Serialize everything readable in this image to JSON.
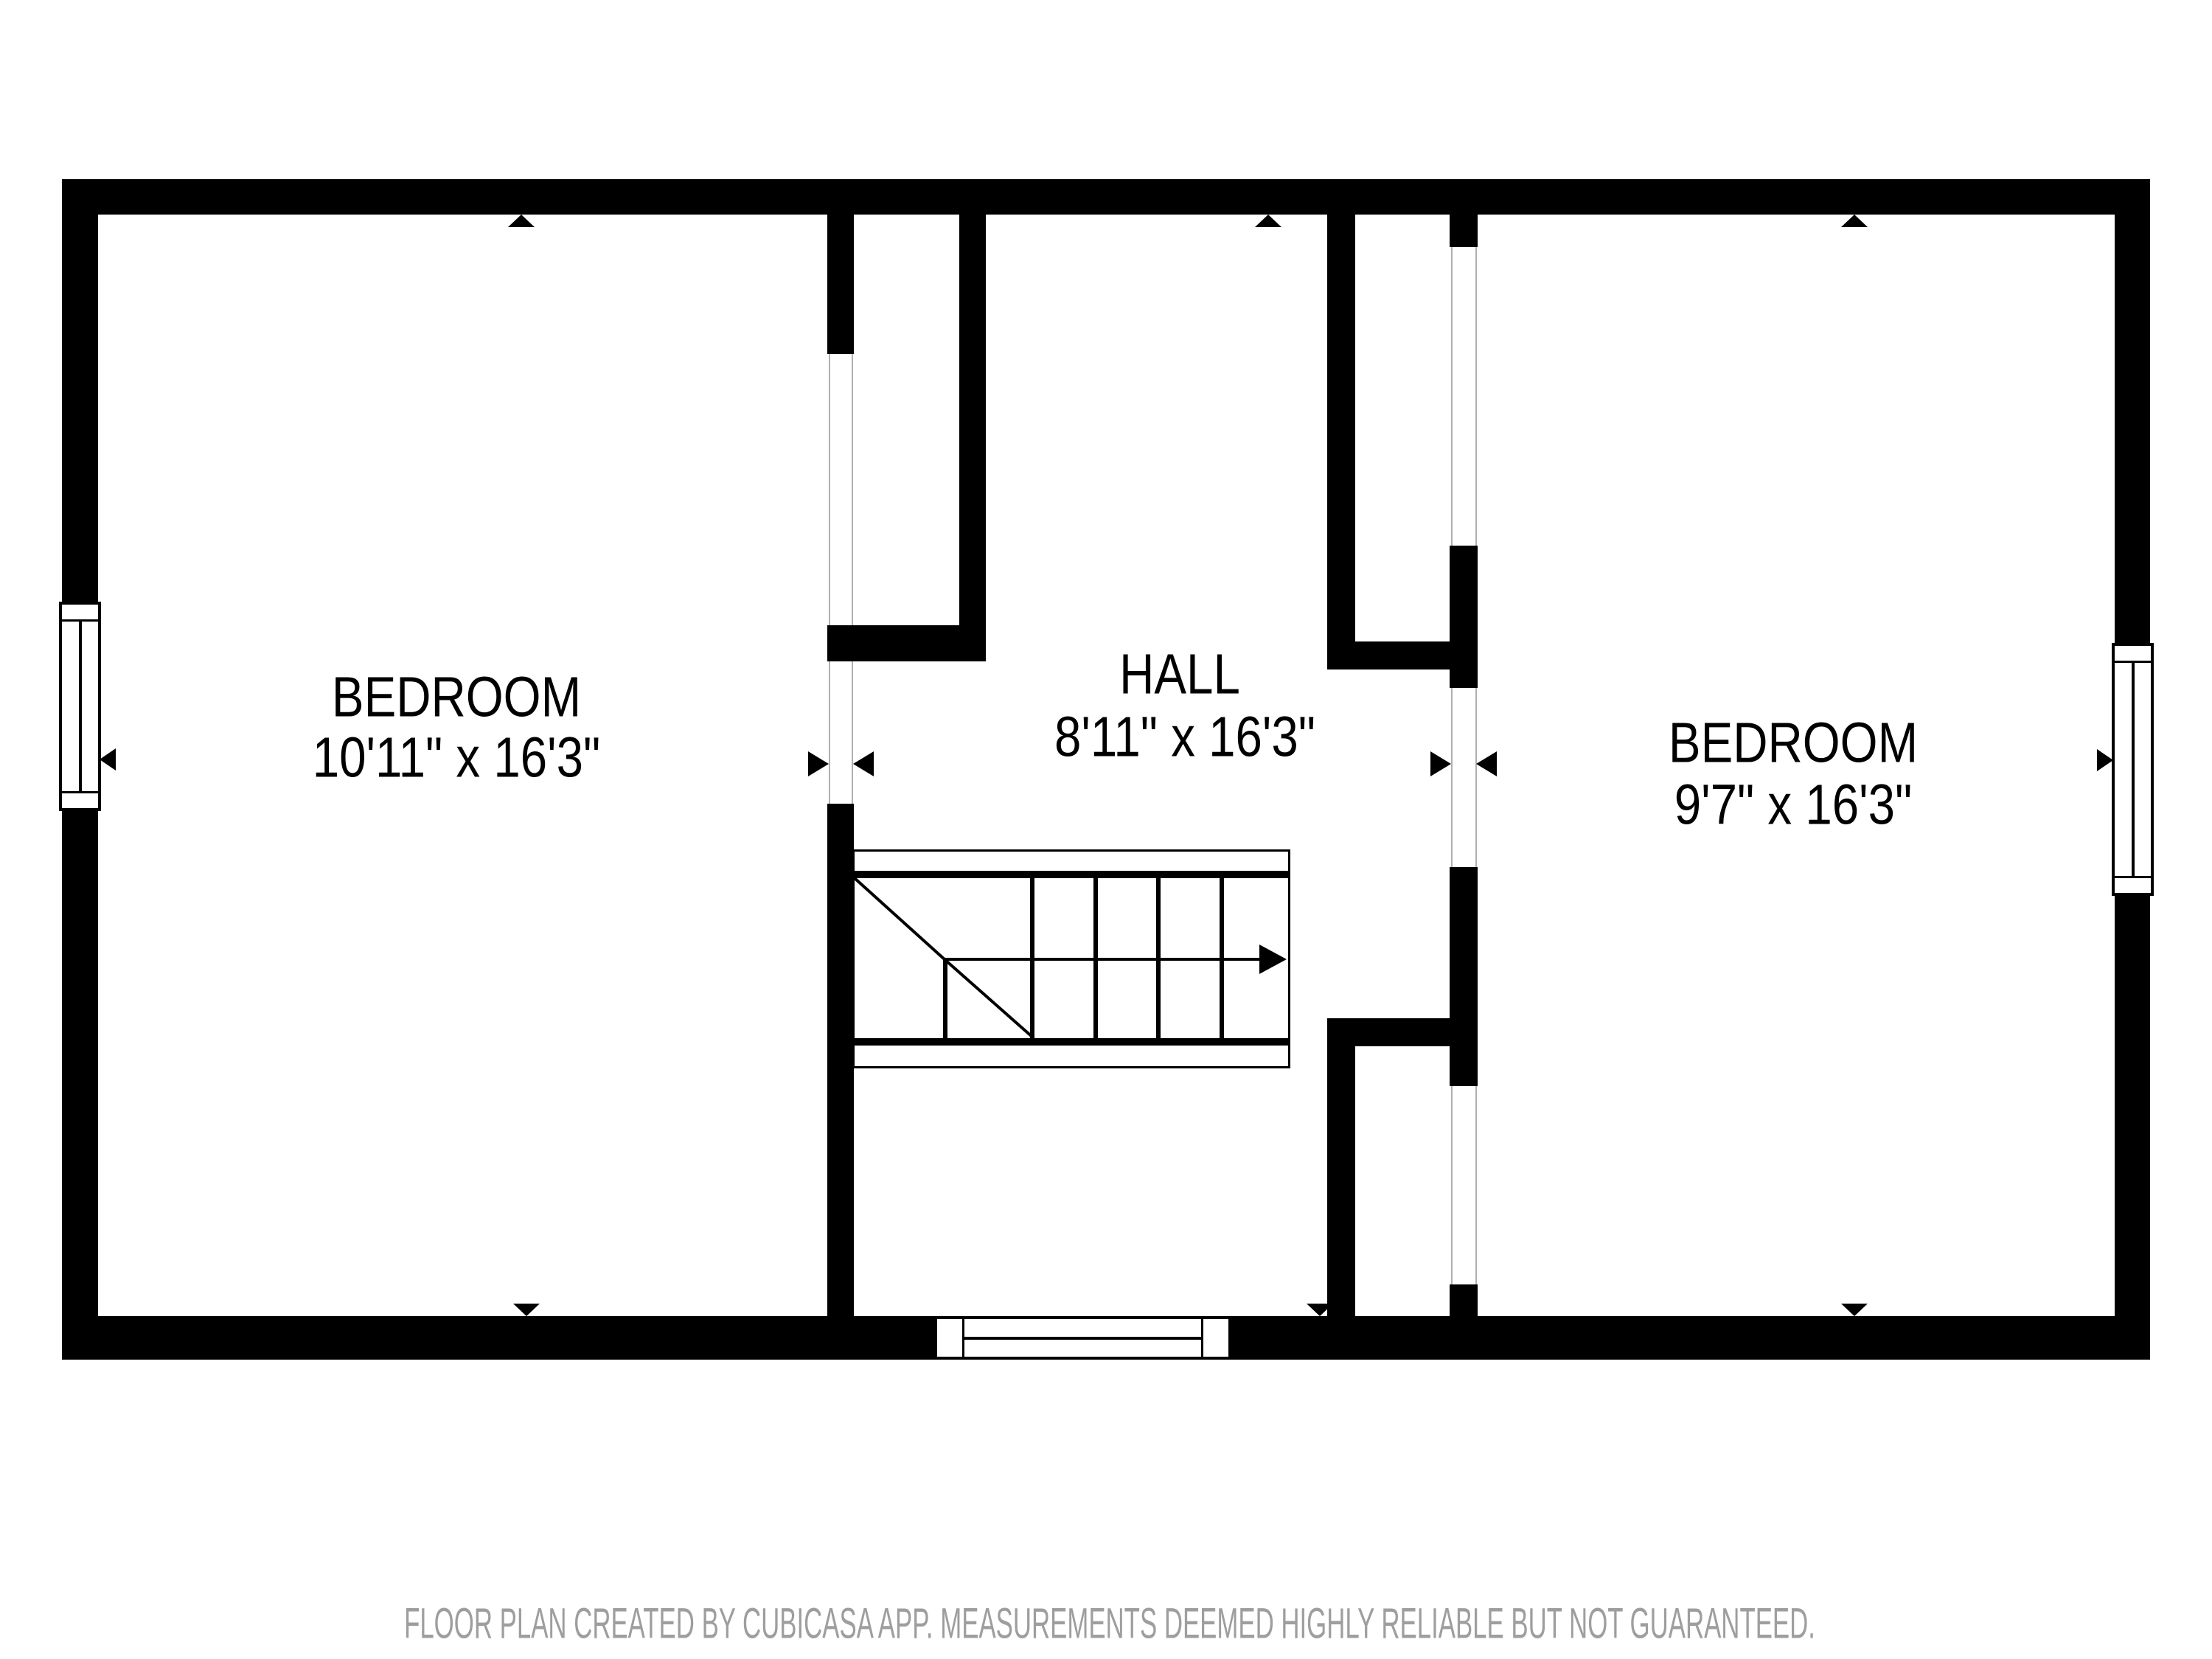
{
  "colors": {
    "wall": "#000000",
    "background": "#ffffff",
    "text": "#000000",
    "muted_text": "#9e9e9e",
    "opening_line": "#b0b0b0"
  },
  "rooms": [
    {
      "id": "bedroom-left",
      "name": "BEDROOM",
      "dimensions": "10'11\" x 16'3\""
    },
    {
      "id": "hall",
      "name": "HALL",
      "dimensions": "8'11\" x 16'3\""
    },
    {
      "id": "bedroom-right",
      "name": "BEDROOM",
      "dimensions": "9'7\" x 16'3\""
    }
  ],
  "features": {
    "windows": [
      "left-wall-window",
      "right-wall-window",
      "bottom-wall-window"
    ],
    "stairs": {
      "type": "switchback",
      "direction_icon": "arrow-right"
    },
    "icons": {
      "opening_marker_left": "triangle-right",
      "opening_marker_right": "triangle-left",
      "wall_marker_top": "triangle-up",
      "wall_marker_bottom": "triangle-down"
    }
  },
  "footer": {
    "disclaimer": "FLOOR PLAN CREATED BY CUBICASA APP. MEASUREMENTS DEEMED HIGHLY RELIABLE BUT NOT GUARANTEED."
  }
}
